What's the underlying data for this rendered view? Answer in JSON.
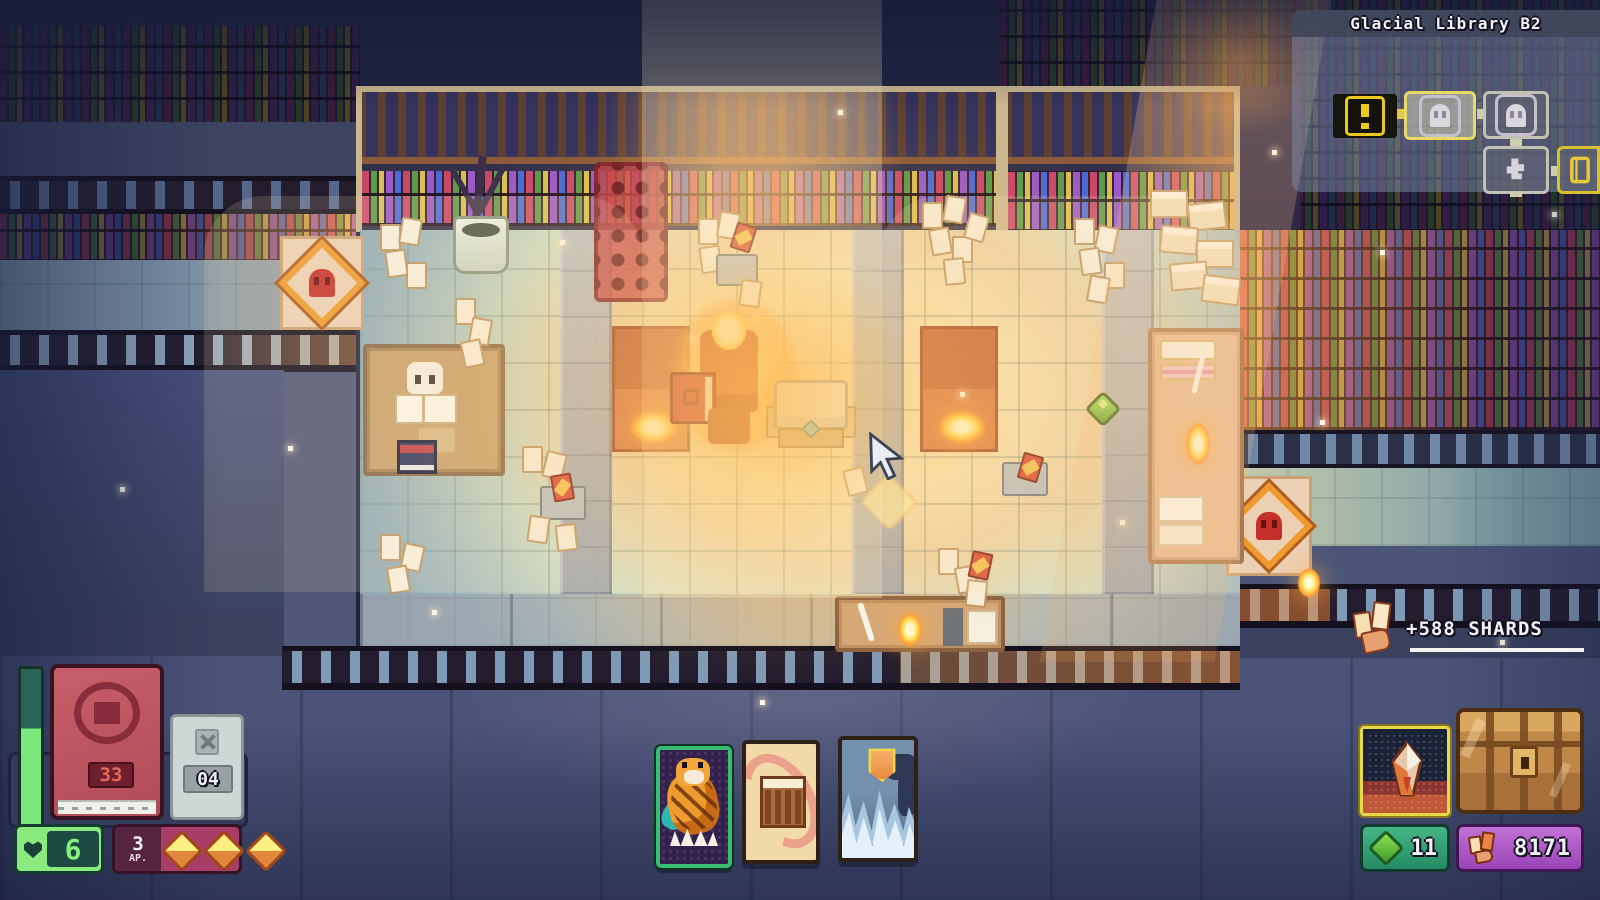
{
  "minimap": {
    "title": "Glacial Library B2",
    "rooms": [
      {
        "name": "alert-room",
        "icon": "exclamation-icon"
      },
      {
        "name": "current-room",
        "icon": "ghost-icon"
      },
      {
        "name": "scouted-room",
        "icon": "ghost-icon"
      },
      {
        "name": "puzzle-room",
        "icon": "puzzle-icon"
      },
      {
        "name": "card-room",
        "icon": "book-icon"
      }
    ]
  },
  "notification": {
    "shards_gain": "+588 SHARDS"
  },
  "stats": {
    "deck_count": "33",
    "discard_count": "04",
    "hp": "6",
    "ap": "3",
    "ap_label": "AP.",
    "ap_pips": 3,
    "gems": "11",
    "shards": "8171"
  },
  "hand": {
    "cards": [
      {
        "name": "tiger-card"
      },
      {
        "name": "library-card"
      },
      {
        "name": "ice-shield-card"
      }
    ]
  },
  "colors": {
    "hp_green": "#7be87b",
    "ap_magenta": "#a83e68",
    "gem_teal": "#2f9c72",
    "shard_purple": "#a658c0",
    "glow_orange": "#ffb347",
    "minimap_highlight": "#ead964"
  }
}
